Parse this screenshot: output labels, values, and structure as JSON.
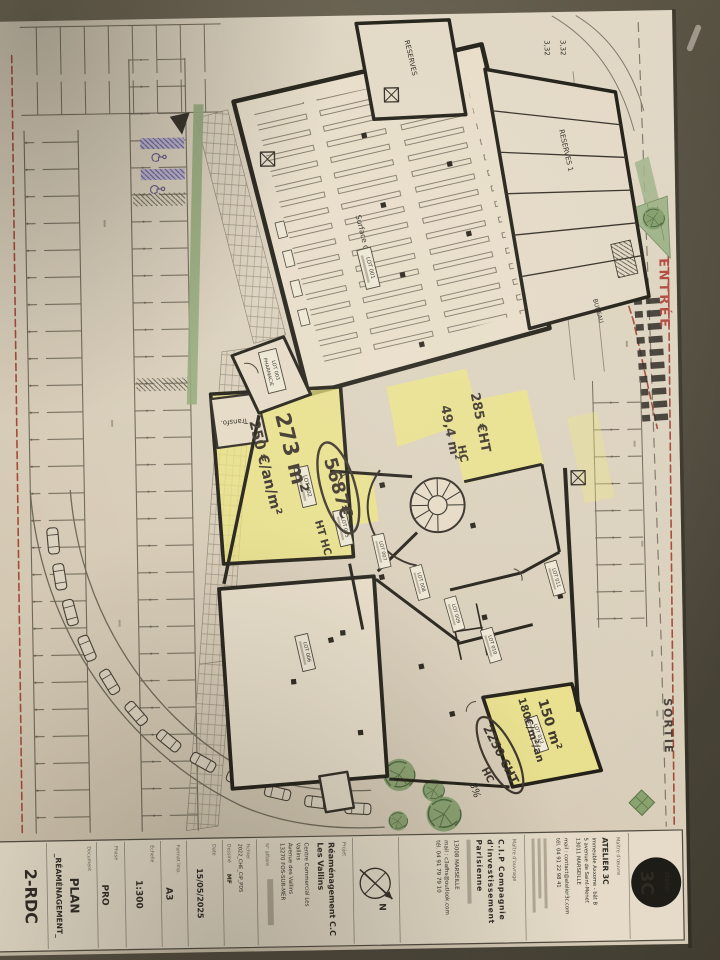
{
  "colors": {
    "background": "#55503f",
    "paper": "#d9cfbe",
    "highlighter_yellow": "#efe97a",
    "entrance_red": "#b0423a",
    "handicap_purple": "#8a82b0",
    "landscape_green": "#7d9a6f",
    "ink": "#2b2620"
  },
  "plan": {
    "entree": "ENTRÉE",
    "sortie": "SORTIE",
    "transfo": "Transfo.",
    "surface_vente": "Surface de vente",
    "reserves": "RESERVES",
    "reserves1": "RESERVES 1",
    "bureau": "BUREAU",
    "dim": "3,32",
    "slope": "8%"
  },
  "lots": {
    "l1": "LOT 001",
    "l2": "LOT 002",
    "l3a": "LOT 003",
    "l3b": "PHARMACIE",
    "l5": "LOT 005",
    "l6": "LOT 006",
    "l7": "LOT 007",
    "l8": "LOT 008",
    "l9": "LOT 009",
    "l10": "LOT 010",
    "l11": "LOT 011",
    "l12": "LOT 012"
  },
  "handwriting": {
    "area_a": "273 m²",
    "rate_a": "250 €/an/m²",
    "price_a": "5687€",
    "suffix_a": "HT HC",
    "price_b": "285 €HT",
    "price_b2": "HC",
    "area_b": "49,4 m²",
    "area_c": "150 m²",
    "rate_c": "180€/m²/an",
    "price_c": "2250 €HT",
    "price_c2": "HC"
  },
  "title_block": {
    "logo_small": "atelier",
    "logo_big": "3C",
    "architect_label": "Maître d'œuvre",
    "architect_name": "ATELIER 3C",
    "architect_addr_1": "Immeuble Axxome - bât B",
    "architect_addr_2": "5 avenue de Saint-Menet",
    "architect_addr_3": "13011 MARSEILLE",
    "architect_mail": "mail : contact@atelier3c.com",
    "architect_tel": "tél. 04 91 22 98 41",
    "owner_label": "Maître d'ouvrage",
    "owner_name_1": "C.I.P Compagnie",
    "owner_name_2": "d'investissement",
    "owner_name_3": "Parisienne",
    "owner_city": "13008 MARSEILLE",
    "owner_mail": "mail : c3afhs@outlook.com",
    "owner_tel": "tél. 04 91 79 79 10",
    "north_label": "N",
    "project_label": "Projet",
    "project_name_1": "Réaménagement C.C",
    "project_name_2": "Les Vallins",
    "project_addr_1": "Centre Commercial Les",
    "project_addr_2": "Vallins",
    "project_addr_3": "Avenue des Vallins",
    "project_addr_4": "13270 FOS-SUR-MER",
    "affaire_label": "N° affaire",
    "file_label": "Fichier",
    "file_value": "2022_CHE_CIP_PDS",
    "drawn_label": "Dessiné",
    "drawn_value": "MF",
    "date_label": "Date",
    "date_value": "15/05/2025",
    "format_label": "Format imp.",
    "format_value": "A3",
    "scale_label": "Échelle",
    "scale_value": "1:300",
    "phase_label": "Phase",
    "phase_value": "PRO",
    "document_label": "Document",
    "document_value_1": "PLAN",
    "document_value_2": "_RÉAMÉNAGEMENT_",
    "sheet_number": "2-RDC"
  }
}
